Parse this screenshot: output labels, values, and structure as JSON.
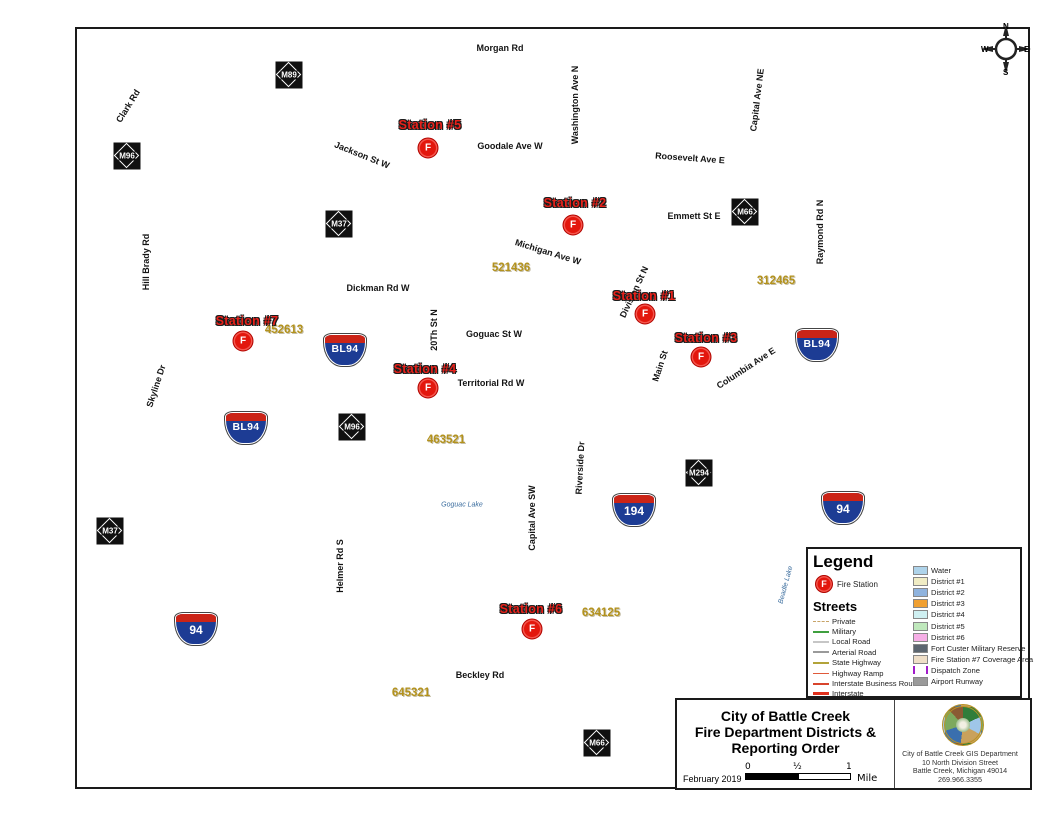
{
  "colors": {
    "district1": "#F4F1D3",
    "district2": "#A9C7E6",
    "district3": "#F3B04A",
    "district4": "#D9F0F3",
    "district5": "#C9EABF",
    "district6": "#F8C4EE",
    "fort_custer": "#8D969C",
    "station7_area": "#F6DDC3",
    "water": "#A8D2EE",
    "dispatch": "#A21CCB",
    "interstate": "#E8492A",
    "state_hwy": "#B2A339",
    "station_red": "#E3170D"
  },
  "map": {
    "fire_marker_letter": "F",
    "stations": [
      {
        "label": "Station #5",
        "lx": 430,
        "ly": 125,
        "mx": 428,
        "my": 148
      },
      {
        "label": "Station #2",
        "lx": 575,
        "ly": 203,
        "mx": 573,
        "my": 225
      },
      {
        "label": "Station #1",
        "lx": 644,
        "ly": 296,
        "mx": 645,
        "my": 314
      },
      {
        "label": "Station #3",
        "lx": 706,
        "ly": 338,
        "mx": 701,
        "my": 357
      },
      {
        "label": "Station #7",
        "lx": 247,
        "ly": 321,
        "mx": 243,
        "my": 341
      },
      {
        "label": "Station #4",
        "lx": 425,
        "ly": 369,
        "mx": 428,
        "my": 388
      },
      {
        "label": "Station #6",
        "lx": 531,
        "ly": 609,
        "mx": 532,
        "my": 629
      }
    ],
    "reporting_codes": [
      {
        "text": "521436",
        "x": 511,
        "y": 268
      },
      {
        "text": "312465",
        "x": 776,
        "y": 281
      },
      {
        "text": "452613",
        "x": 284,
        "y": 330
      },
      {
        "text": "463521",
        "x": 446,
        "y": 440
      },
      {
        "text": "634125",
        "x": 601,
        "y": 613
      },
      {
        "text": "645321",
        "x": 411,
        "y": 693
      }
    ],
    "road_labels": [
      {
        "text": "Morgan Rd",
        "x": 500,
        "y": 48,
        "r": 0
      },
      {
        "text": "Clark Rd",
        "x": 128,
        "y": 106,
        "r": -58
      },
      {
        "text": "Jackson St W",
        "x": 362,
        "y": 155,
        "r": 22
      },
      {
        "text": "Goodale Ave W",
        "x": 510,
        "y": 146,
        "r": 0
      },
      {
        "text": "Washington Ave N",
        "x": 575,
        "y": 105,
        "r": -90
      },
      {
        "text": "Roosevelt Ave E",
        "x": 690,
        "y": 158,
        "r": 4
      },
      {
        "text": "Capital Ave NE",
        "x": 757,
        "y": 100,
        "r": -83
      },
      {
        "text": "Michigan Ave W",
        "x": 548,
        "y": 252,
        "r": 17
      },
      {
        "text": "Emmett St E",
        "x": 694,
        "y": 216,
        "r": 0
      },
      {
        "text": "Raymond Rd N",
        "x": 820,
        "y": 232,
        "r": -90
      },
      {
        "text": "Dickman Rd W",
        "x": 378,
        "y": 288,
        "r": 0
      },
      {
        "text": "Hill Brady Rd",
        "x": 146,
        "y": 262,
        "r": -90
      },
      {
        "text": "20Th St N",
        "x": 434,
        "y": 330,
        "r": -90
      },
      {
        "text": "Goguac St W",
        "x": 494,
        "y": 334,
        "r": 0
      },
      {
        "text": "Territorial Rd W",
        "x": 491,
        "y": 383,
        "r": 0
      },
      {
        "text": "Main St",
        "x": 660,
        "y": 366,
        "r": -72
      },
      {
        "text": "Columbia Ave E",
        "x": 746,
        "y": 368,
        "r": -33
      },
      {
        "text": "Skyline Dr",
        "x": 156,
        "y": 386,
        "r": -72
      },
      {
        "text": "Division St N",
        "x": 634,
        "y": 292,
        "r": -65
      },
      {
        "text": "Capital Ave SW",
        "x": 532,
        "y": 518,
        "r": -90
      },
      {
        "text": "Riverside Dr",
        "x": 580,
        "y": 468,
        "r": -87
      },
      {
        "text": "Helmer Rd S",
        "x": 340,
        "y": 566,
        "r": -90
      },
      {
        "text": "Beckley Rd",
        "x": 480,
        "y": 675,
        "r": 0
      },
      {
        "text": "Goguac Lake",
        "x": 462,
        "y": 505,
        "r": 0,
        "kind": "lake"
      },
      {
        "text": "Beadle Lake",
        "x": 786,
        "y": 585,
        "r": -75,
        "kind": "lake"
      }
    ],
    "shields": [
      {
        "kind": "m",
        "text": "M89",
        "x": 289,
        "y": 75
      },
      {
        "kind": "m",
        "text": "M96",
        "x": 127,
        "y": 156
      },
      {
        "kind": "m",
        "text": "M37",
        "x": 339,
        "y": 224
      },
      {
        "kind": "m",
        "text": "M96",
        "x": 352,
        "y": 427
      },
      {
        "kind": "m",
        "text": "M37",
        "x": 110,
        "y": 531
      },
      {
        "kind": "m",
        "text": "M66",
        "x": 745,
        "y": 212
      },
      {
        "kind": "m",
        "text": "M294",
        "x": 699,
        "y": 473
      },
      {
        "kind": "m",
        "text": "M66",
        "x": 597,
        "y": 743
      },
      {
        "kind": "bl",
        "text": "BL94",
        "x": 345,
        "y": 350
      },
      {
        "kind": "bl",
        "text": "BL94",
        "x": 246,
        "y": 428
      },
      {
        "kind": "bl",
        "text": "BL94",
        "x": 817,
        "y": 345
      },
      {
        "kind": "i",
        "text": "94",
        "x": 196,
        "y": 629
      },
      {
        "kind": "i",
        "text": "194",
        "x": 634,
        "y": 510
      },
      {
        "kind": "i",
        "text": "94",
        "x": 843,
        "y": 508
      }
    ],
    "compass": {
      "n": "N",
      "e": "E",
      "s": "S",
      "w": "W"
    }
  },
  "legend": {
    "title": "Legend",
    "fire_station_label": "Fire Station",
    "streets_title": "Streets",
    "streets": [
      {
        "label": "Private",
        "color": "#C8A468",
        "dash": "3 3",
        "width": 1.5
      },
      {
        "label": "Military",
        "color": "#3FA03F",
        "dash": "",
        "width": 2
      },
      {
        "label": "Local Road",
        "color": "#C6C6C6",
        "dash": "",
        "width": 2
      },
      {
        "label": "Arterial Road",
        "color": "#9A9A9A",
        "dash": "",
        "width": 2
      },
      {
        "label": "State Highway",
        "color": "#B2A339",
        "dash": "",
        "width": 2
      },
      {
        "label": "Highway Ramp",
        "color": "#E05A3A",
        "dash": "",
        "width": 1.5
      },
      {
        "label": "Interstate Business Route",
        "color": "#D8442C",
        "dash": "",
        "width": 2
      },
      {
        "label": "Interstate",
        "color": "#E0301C",
        "dash": "",
        "width": 3
      }
    ],
    "areas": [
      {
        "label": "Water",
        "color": "#AED3EA",
        "kind": "fill"
      },
      {
        "label": "District #1",
        "color": "#F0ECC4",
        "kind": "fill"
      },
      {
        "label": "District #2",
        "color": "#8FB3DE",
        "kind": "fill"
      },
      {
        "label": "District #3",
        "color": "#F0A032",
        "kind": "fill"
      },
      {
        "label": "District #4",
        "color": "#CFF0F2",
        "kind": "fill"
      },
      {
        "label": "District #5",
        "color": "#BFE8BC",
        "kind": "fill"
      },
      {
        "label": "District #6",
        "color": "#F6AEE6",
        "kind": "fill"
      },
      {
        "label": "Fort Custer Military Reserve",
        "color": "#5C6670",
        "kind": "fill"
      },
      {
        "label": "Fire Station #7 Coverage Area",
        "color": "#EFDFC8",
        "kind": "fill"
      },
      {
        "label": "Dispatch Zone",
        "color": "#A21CCB",
        "kind": "bracket"
      },
      {
        "label": "Airport Runway",
        "color": "#9A9A9A",
        "kind": "fill"
      }
    ]
  },
  "title_block": {
    "line1": "City of Battle Creek",
    "line2": "Fire Department Districts &",
    "line3": "Reporting Order",
    "date": "February 2019",
    "scale": {
      "zero": "0",
      "half": "½",
      "one": "1",
      "unit": "Mile"
    },
    "org_lines": [
      "City of Battle Creek GIS Department",
      "10 North Division Street",
      "Battle Creek, Michigan 49014",
      "269.966.3355"
    ]
  }
}
